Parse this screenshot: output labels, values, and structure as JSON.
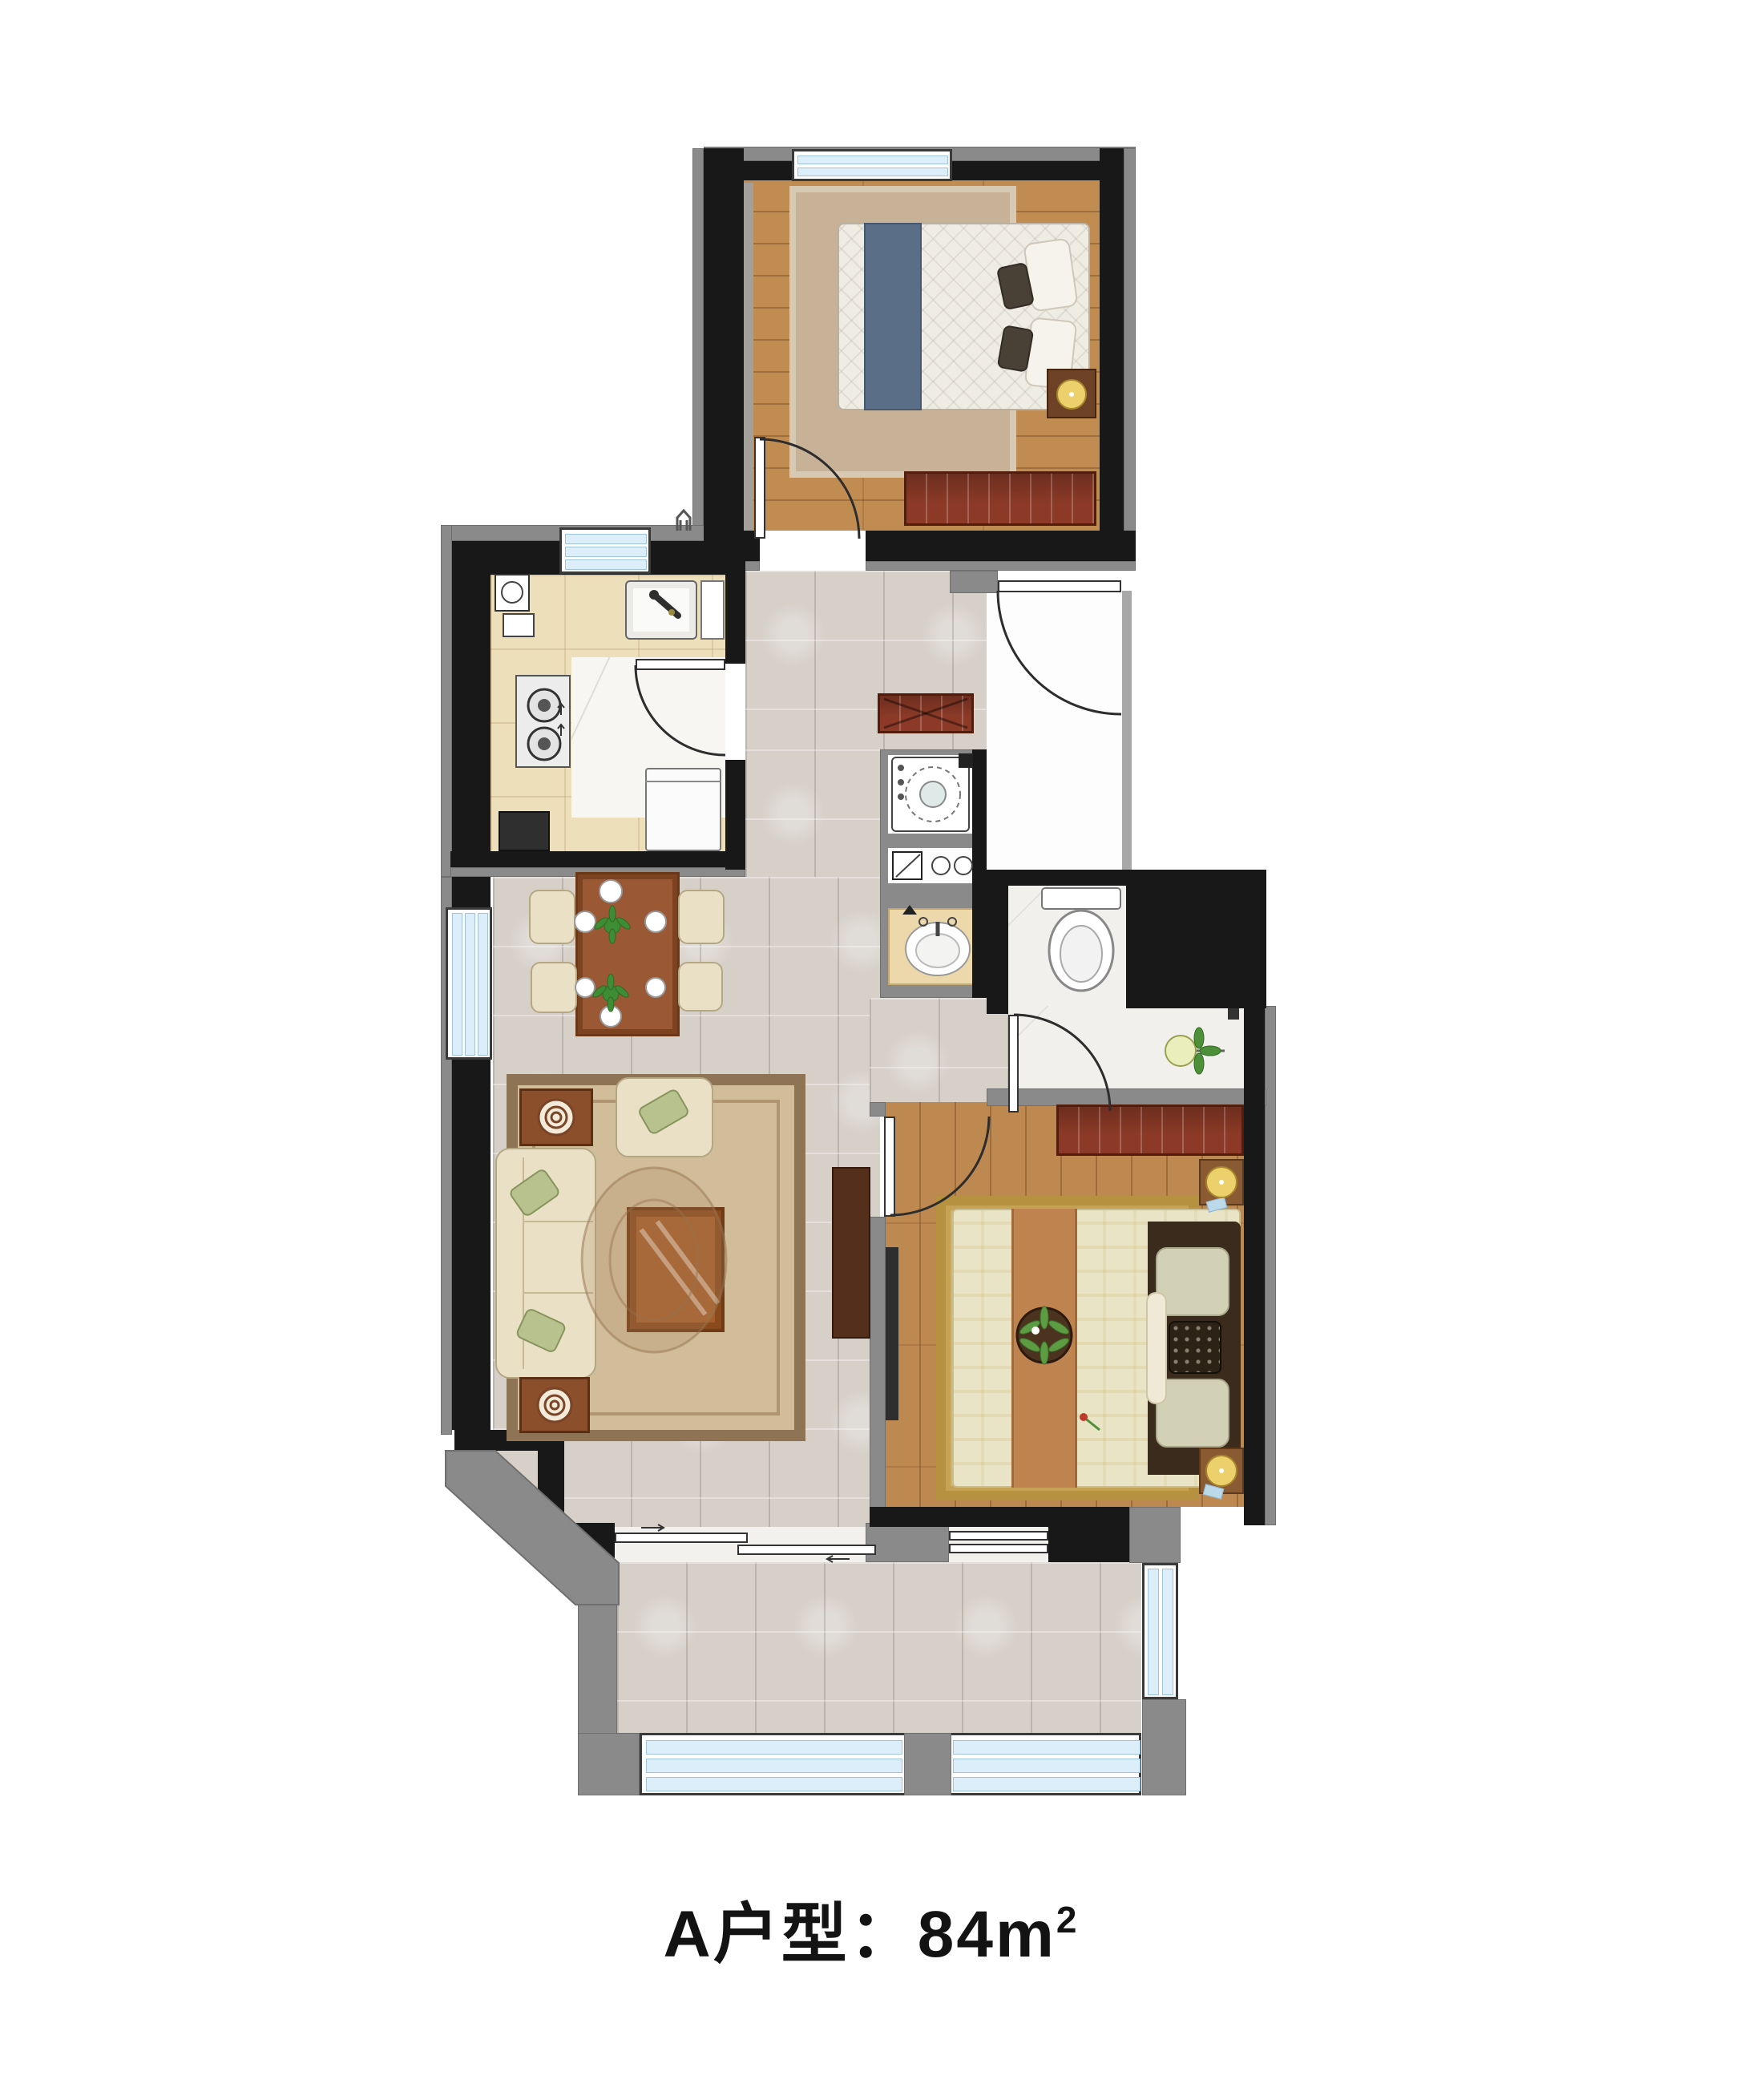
{
  "title": {
    "text": "A户型：84m",
    "sup": "2"
  },
  "palette": {
    "wall": "#181818",
    "wallAccent": "#8a8a8a",
    "windowGlass": "#dceefa",
    "marbleFloor": "#d6d0c9",
    "woodFloor": "#c18c52",
    "woodFloorMaster": "#bd8950",
    "kitchenTile": "#eedfbb",
    "bathFloor": "#f2f0ed",
    "cabinetRed": "#8c3a27",
    "sofaCream": "#eae0c6",
    "livingRug": "#d2bd9a",
    "masterRug": "#d3b469",
    "lampGold": "#e8cc66",
    "plantGreen": "#4e8f3a"
  }
}
